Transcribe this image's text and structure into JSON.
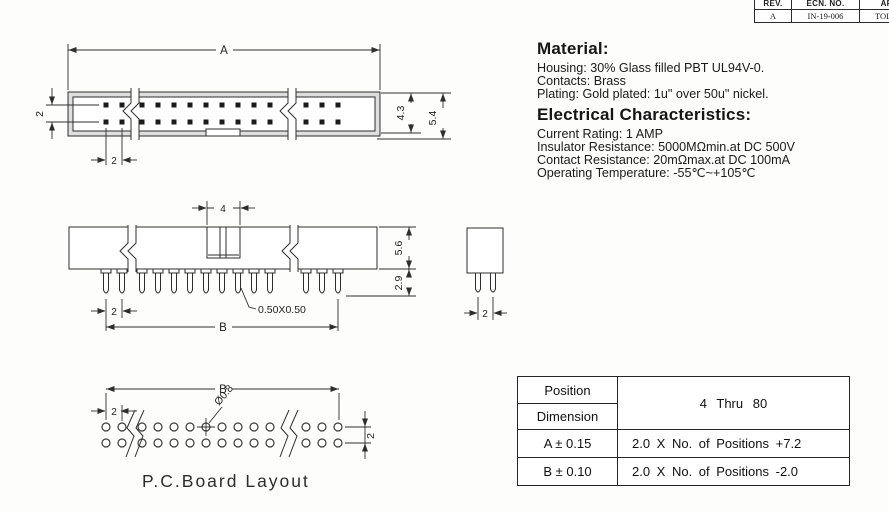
{
  "revision_table": {
    "headers": [
      "REV.",
      "ECN. NO.",
      "APP."
    ],
    "row": [
      "A",
      "IN-19-006",
      "TOL CH"
    ]
  },
  "material": {
    "title": "Material:",
    "lines": [
      "Housing: 30% Glass filled PBT UL94V-0.",
      "Contacts: Brass",
      "Plating: Gold plated: 1u\" over 50u\" nickel."
    ]
  },
  "electrical": {
    "title": "Electrical Characteristics:",
    "lines": [
      "Current Rating: 1 AMP",
      "Insulator Resistance: 5000MΩmin.at DC 500V",
      "Contact Resistance: 20mΩmax.at DC 100mA",
      "Operating Temperature: -55℃~+105℃"
    ]
  },
  "spec_table": {
    "corner_top": "Position",
    "corner_bottom": "Dimension",
    "range": "4 Thru 80",
    "rows": [
      {
        "dim": "A ± 0.15",
        "formula": "2.0 X No. of Positions +7.2"
      },
      {
        "dim": "B ± 0.10",
        "formula": "2.0 X No. of Positions -2.0"
      }
    ]
  },
  "dims": {
    "top_view": {
      "a": "A",
      "row_pitch": "2",
      "pin_pitch": "2",
      "inner_height": "4.3",
      "outer_height": "5.4"
    },
    "side_view": {
      "key_width": "4",
      "pin_pitch": "2",
      "span": "B",
      "body_height": "5.6",
      "pin_length": "2.9",
      "pin_size": "0.50X0.50"
    },
    "end_view": {
      "pin_pitch": "2"
    },
    "pcb_layout": {
      "span": "B",
      "pin_pitch": "2",
      "row_pitch": "2",
      "hole_dia": "Ø0.8",
      "caption": "P.C.Board Layout"
    }
  }
}
